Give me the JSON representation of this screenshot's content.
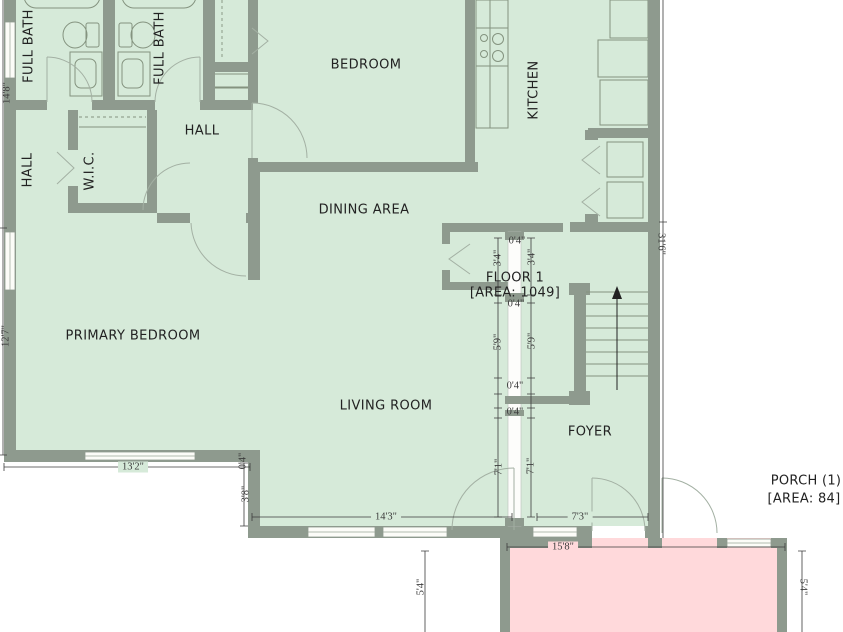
{
  "rooms": {
    "full_bath_1": "FULL BATH",
    "full_bath_2": "FULL BATH",
    "hall_side": "HALL",
    "wic": "W.I.C.",
    "hall": "HALL",
    "bedroom": "BEDROOM",
    "kitchen": "KITCHEN",
    "dining": "DINING AREA",
    "primary_bedroom": "PRIMARY BEDROOM",
    "living_room": "LIVING ROOM",
    "foyer": "FOYER"
  },
  "areas": {
    "floor": {
      "name": "FLOOR 1",
      "area": "[AREA: 1049]"
    },
    "porch": {
      "name": "PORCH (1)",
      "area": "[AREA: 84]"
    }
  },
  "dims": {
    "left_top": "14'8\"",
    "left_bottom": "12'7\"",
    "right_side": "31'6\"",
    "pb_width": "13'2\"",
    "step_small": "0'4\"",
    "step": "3'8\"",
    "lr_width": "14'3\"",
    "foyer_width": "7'3\"",
    "porch_width": "15'8\"",
    "porch_depth_l": "5'4\"",
    "porch_depth_r": "5'4\"",
    "c_04_top": "0'4\"",
    "c_34_l": "3'4\"",
    "c_34_r": "3'4\"",
    "c_04_mid": "0'4\"",
    "c_59_l": "5'9\"",
    "c_59_r": "5'9\"",
    "c_04_low1": "0'4\"",
    "c_04_low2": "0'4\"",
    "c_71_l": "7'1\"",
    "c_71_r": "7'1\""
  },
  "colors": {
    "floor": "#d6ead9",
    "porch": "#ffd9db",
    "wall": "#8e9a8e",
    "dim": "#3c3c3c",
    "label": "#222222"
  }
}
